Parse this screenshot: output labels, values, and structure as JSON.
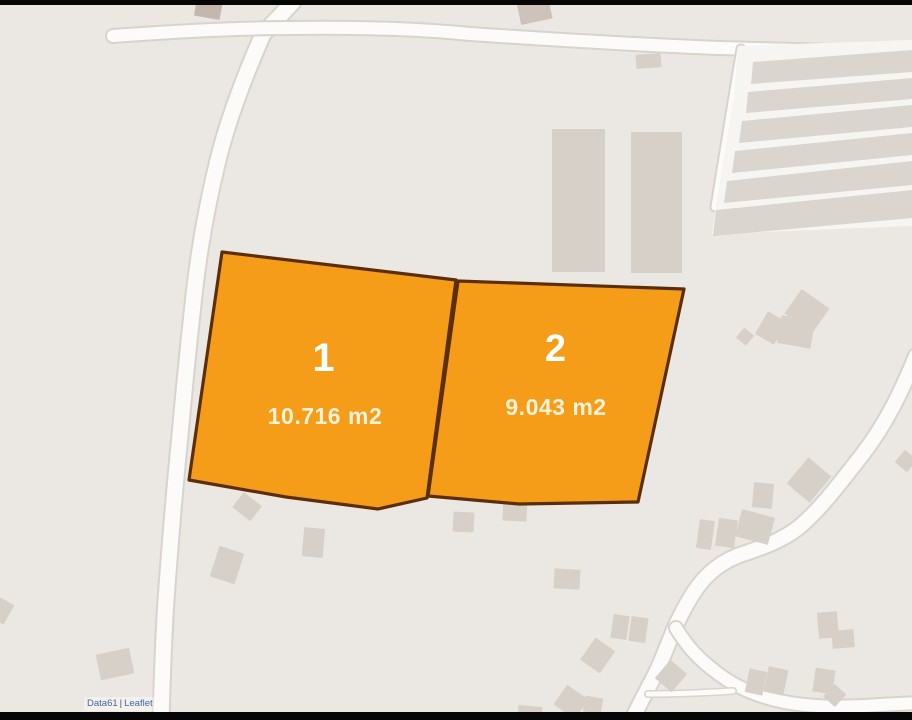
{
  "map": {
    "plots": [
      {
        "number": "1",
        "area": "10.716 m2"
      },
      {
        "number": "2",
        "area": "9.043 m2"
      }
    ],
    "attribution": {
      "prefix_link": "Data61",
      "separator": "|",
      "library_link": "Leaflet"
    },
    "colors": {
      "background": "#ebe7e2",
      "letterbox": "#060606",
      "road_fill": "#fcfbf9",
      "road_casing": "#d9d3cd",
      "building": "#d7d0c9",
      "building_dark": "#c4b8ae",
      "greenhouse_strip": "#dbd5cf",
      "greenhouse_base": "#f7f5f2",
      "plot_fill": "#f59d18",
      "plot_stroke": "#5c2e07",
      "plot_number_color": "#ffffff",
      "plot_area_color": "#fdf2d8",
      "attribution_link": "#4169a8"
    }
  }
}
